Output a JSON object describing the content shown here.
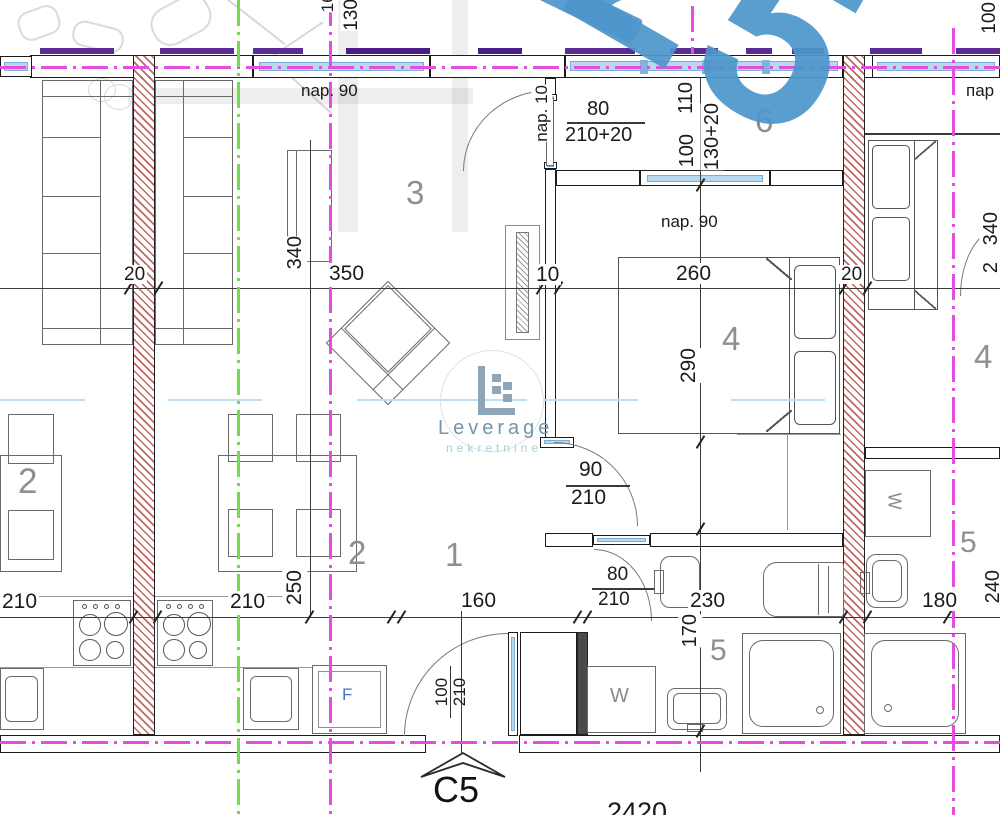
{
  "unit": {
    "code": "C5",
    "total_width": "2420"
  },
  "rooms": {
    "living": "3",
    "hall": "1",
    "kitchen": "2",
    "kitchen_left": "2",
    "bedroom": "4",
    "bedroom_right": "4",
    "bath": "5",
    "bath_right": "5",
    "balcony": "6"
  },
  "dims": {
    "wall_left": "20",
    "living_len": "340",
    "living_w": "350",
    "gap": "10",
    "bed_w": "260",
    "wall_right": "20",
    "bed_len": "290",
    "balc_w": "110",
    "balc_win": "100",
    "balc_win_h": "130+20",
    "balc_door_w": "80",
    "balc_door_h": "210+20",
    "balc_door_sill": "nap. 10",
    "win_sill_living": "nap. 90",
    "win_sill_balc": "nap. 90",
    "top_win_w": "160",
    "top_win_h": "130+",
    "top_right_win": "100",
    "par_right": "пар",
    "bed_door_w": "90",
    "bed_door_h": "210",
    "bath_door_w": "80",
    "bath_door_h": "210",
    "kitchen_left": "210",
    "kitchen_main": "210",
    "kitchen_len": "250",
    "hall_w": "160",
    "bath_w": "230",
    "bath_len": "170",
    "right_w": "180",
    "right_len": "240",
    "right_bed": "340",
    "right_cut": "2",
    "entry_w": "100",
    "entry_h": "210"
  },
  "appliances": {
    "washer": "W",
    "washer_right": "W",
    "fridge": "F"
  },
  "watermark": {
    "digits": "25",
    "brand": "Leverage",
    "brand_sub": "nekretnine"
  },
  "colors": {
    "hatch_red": "#b5504e",
    "axis_magenta": "#e34de0",
    "axis_green": "#6fde4a",
    "window_glass": "#b8d8ef",
    "lintel_purple": "#5a2c94",
    "watermark_blue": "#4d96cb",
    "logo_blue": "#8fa6b8",
    "logo_light": "#a9cdd9",
    "dim_text": "#1b1b1b",
    "room_text": "#8f8f8f"
  }
}
